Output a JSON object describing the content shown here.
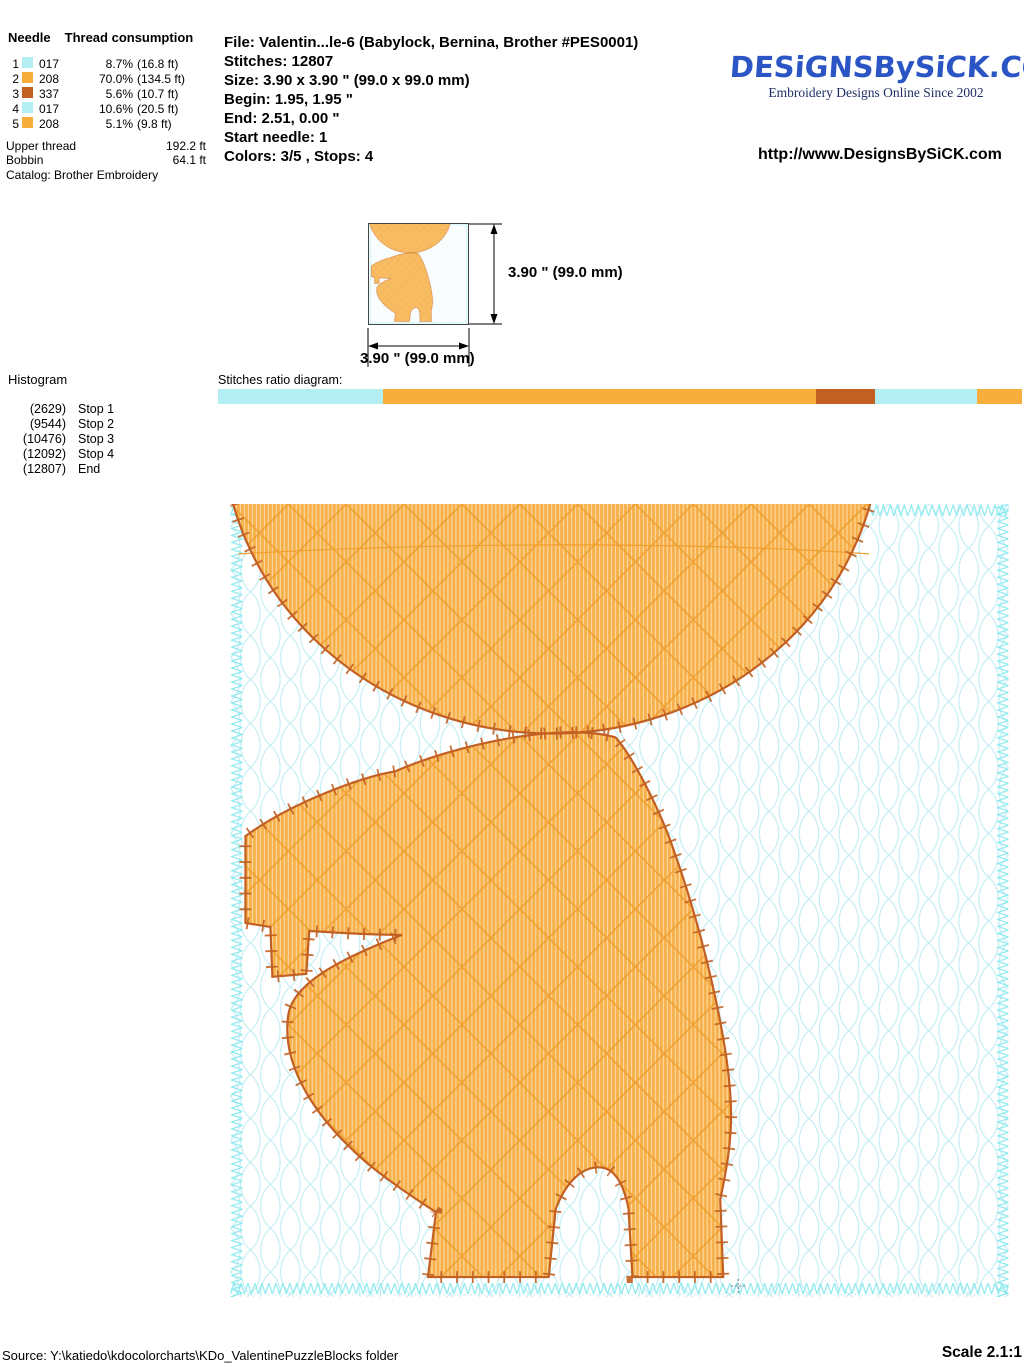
{
  "colors": {
    "thread_017_cyan": "#b2eef2",
    "thread_208_orange": "#f7ae3d",
    "thread_337_rust": "#c25f22",
    "design_fill": "#f7b047",
    "design_outline": "#c25f22",
    "background_lattice": "#bfecf2",
    "logo_blue": "#2b55c4"
  },
  "thread_table": {
    "header_needle": "Needle",
    "header_consumption": "Thread consumption",
    "rows": [
      {
        "needle": "1",
        "code": "017",
        "percent": "8.7%",
        "length": "(16.8 ft)",
        "color": "#b2eef2"
      },
      {
        "needle": "2",
        "code": "208",
        "percent": "70.0%",
        "length": "(134.5 ft)",
        "color": "#f7ae3d"
      },
      {
        "needle": "3",
        "code": "337",
        "percent": "5.6%",
        "length": "(10.7 ft)",
        "color": "#c25f22"
      },
      {
        "needle": "4",
        "code": "017",
        "percent": "10.6%",
        "length": "(20.5 ft)",
        "color": "#b2eef2"
      },
      {
        "needle": "5",
        "code": "208",
        "percent": "5.1%",
        "length": "(9.8 ft)",
        "color": "#f7ae3d"
      }
    ],
    "upper_thread_label": "Upper thread",
    "upper_thread_value": "192.2 ft",
    "bobbin_label": "Bobbin",
    "bobbin_value": "64.1 ft",
    "catalog": "Catalog: Brother Embroidery"
  },
  "file_info": {
    "lines": [
      "File: Valentin...le-6  (Babylock, Bernina, Brother #PES0001)",
      "Stitches: 12807",
      "Size: 3.90 x 3.90 \" (99.0 x 99.0 mm)",
      "Begin: 1.95, 1.95 \"",
      "End: 2.51, 0.00 \"",
      "Start needle: 1",
      "Colors: 3/5 , Stops: 4"
    ]
  },
  "branding": {
    "logo_text": "DESiGNSBySiCK.COM",
    "tagline": "Embroidery Designs Online Since 2002",
    "url": "http://www.DesignsBySiCK.com"
  },
  "thumbnail": {
    "height_label": "3.90 \" (99.0 mm)",
    "width_label": "3.90 \" (99.0 mm)"
  },
  "histogram": {
    "title": "Histogram",
    "entries": [
      {
        "count": "(2629)",
        "label": "Stop 1"
      },
      {
        "count": "(9544)",
        "label": "Stop 2"
      },
      {
        "count": "(10476)",
        "label": "Stop 3"
      },
      {
        "count": "(12092)",
        "label": "Stop 4"
      },
      {
        "count": "(12807)",
        "label": "End"
      }
    ]
  },
  "ratio_diagram": {
    "label": "Stitches ratio diagram:",
    "segments": [
      {
        "pct": 20.5,
        "color": "#b2eef2"
      },
      {
        "pct": 53.9,
        "color": "#f7ae3d"
      },
      {
        "pct": 7.3,
        "color": "#c25f22"
      },
      {
        "pct": 12.7,
        "color": "#b2eef2"
      },
      {
        "pct": 5.6,
        "color": "#f7ae3d"
      }
    ]
  },
  "footer": {
    "source": "Source: Y:\\katiedo\\kdocolorcharts\\KDo_ValentinePuzzleBlocks folder",
    "scale": "Scale 2.1:1"
  }
}
